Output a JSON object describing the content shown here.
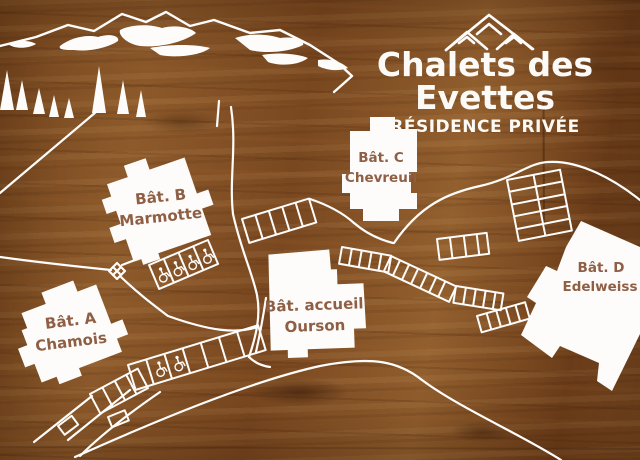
{
  "sign": {
    "title": "Chalets des Evettes",
    "subtitle": "RÉSIDENCE PRIVÉE"
  },
  "buildings": {
    "a": {
      "name": "Bât. A",
      "subtitle": "Chamois"
    },
    "b": {
      "name": "Bât. B",
      "subtitle": "Marmotte"
    },
    "c": {
      "name": "Bât. C",
      "subtitle": "Chevreuil"
    },
    "d": {
      "name": "Bât. D",
      "subtitle": "Edelweiss"
    },
    "accueil": {
      "name": "Bât. accueil",
      "subtitle": "Ourson"
    }
  },
  "icons": {
    "mountain_logo": "mountain-peaks",
    "accessible_parking": "wheelchair"
  },
  "colors": {
    "wood": "#7c4a21",
    "line_white": "#fdfcfa",
    "label_brown": "#8f5f45"
  }
}
